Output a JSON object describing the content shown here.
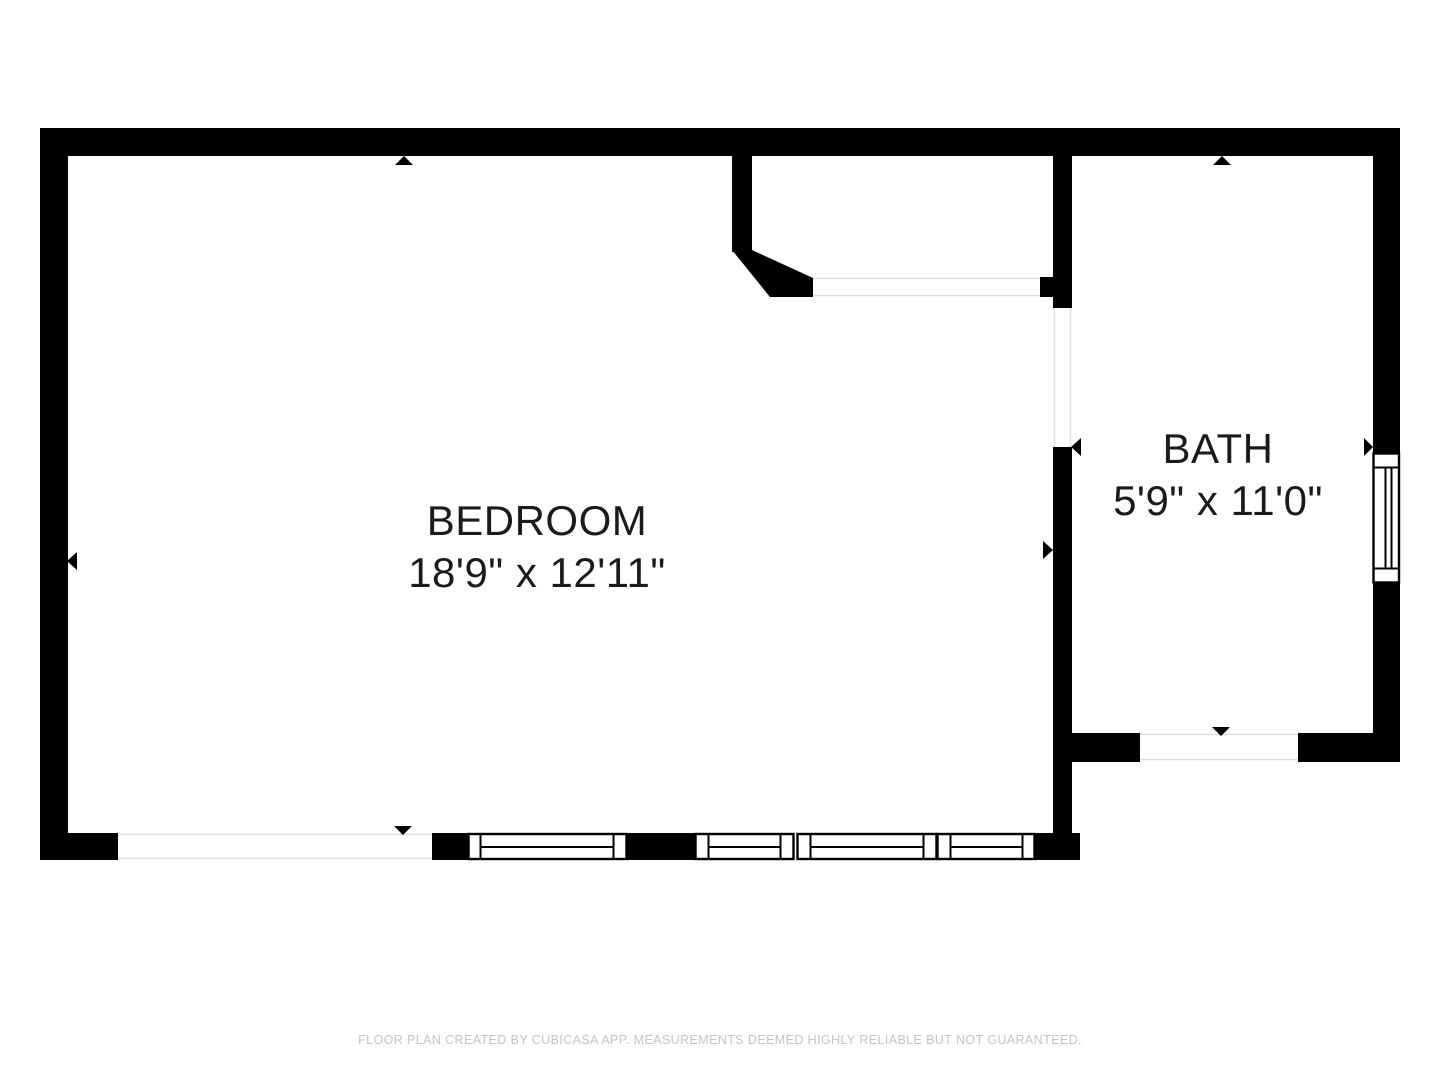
{
  "floor_plan": {
    "rooms": [
      {
        "name": "BEDROOM",
        "dimensions": "18'9\" x 12'11\""
      },
      {
        "name": "BATH",
        "dimensions": "5'9\" x 11'0\""
      }
    ],
    "footer": "FLOOR PLAN CREATED BY CUBICASA APP. MEASUREMENTS DEEMED HIGHLY RELIABLE BUT NOT GUARANTEED.",
    "icons": [
      "door-marker-triangle-up",
      "door-marker-triangle-down",
      "door-marker-triangle-left",
      "door-marker-triangle-right",
      "window-symbol"
    ],
    "colors": {
      "wall": "#000000",
      "background": "#ffffff",
      "opening_line": "#dcdcdc",
      "label_text": "#1b1b1b",
      "footer_text": "#c4c4c4"
    }
  }
}
